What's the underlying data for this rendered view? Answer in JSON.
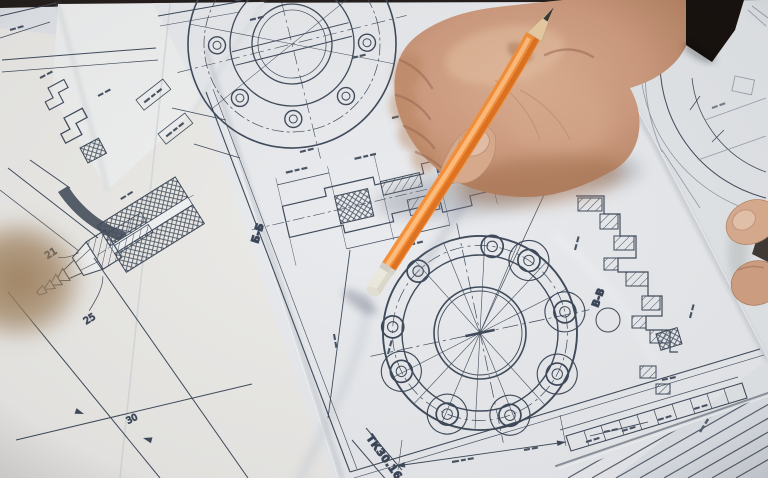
{
  "scene": {
    "title": "Hand of an engineer pointing with an orange pencil at mechanical blueprint drawings spread on a desk",
    "labels": {
      "sheet_code": "ТК30.16.0",
      "section_label_main": "Б-Б",
      "section_label_right": "B-B",
      "dim_left_upper": "21",
      "dim_left_lower": "25",
      "dim_bottom_left": "30"
    },
    "drawings": [
      "top flange with bolt circle (partially visible)",
      "sectional view Б-Б with crosshatched parts",
      "large flange with eight-hole bolt circle",
      "stepped shaft section with hatching",
      "hose-fitting cross-section with barbed nipple",
      "title block strip with table cells",
      "ruled hatching sheet (bottom right)"
    ],
    "colors": {
      "desk": "#241f1c",
      "paper": "#e9ebee",
      "paper_warm": "#ecebe7",
      "paper_shaded": "#dfe3e8",
      "ink": "#414c5c",
      "ink_faint": "#8d97a3",
      "pencil_orange": "#f5903a",
      "pencil_orange_dark": "#d96f1e",
      "pencil_highlight": "#ffc184",
      "pencil_wood": "#e9cda4",
      "pencil_lead": "#3c3936",
      "eraser": "#eceadf",
      "skin": "#cf9c80",
      "skin_light": "#e3b999",
      "skin_shadow": "#a97b61",
      "sleeve": "#17120e",
      "nail": "#e4bfa8"
    }
  }
}
